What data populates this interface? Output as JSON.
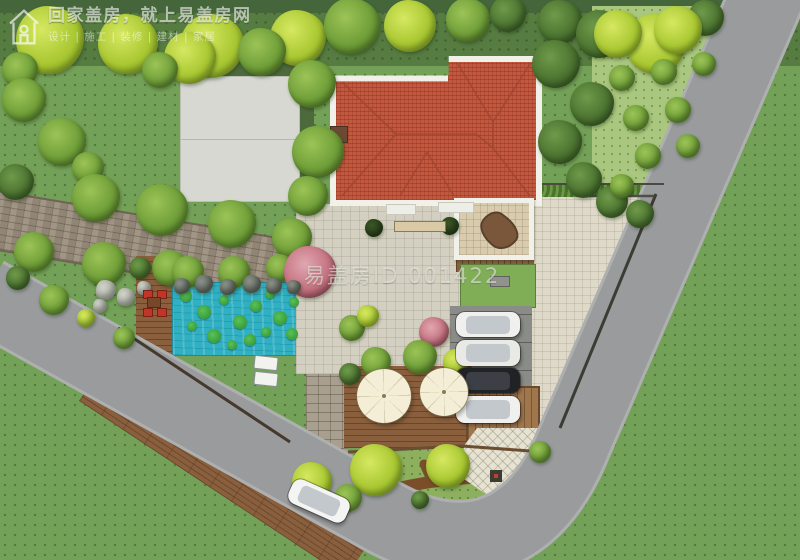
{
  "watermark": {
    "brand": "回家盖房，就上易盖房网",
    "tagline": "设计 | 施工 | 装修 | 建材 | 家居",
    "site_id": "易盖房ID 001422"
  },
  "colors": {
    "grass_base": "#74a158",
    "grass_dark": "#567c41",
    "orchard": "#a9c77e",
    "road": "#999b9d",
    "road_curb": "#aeb0b0",
    "paver_light": "#d4d0c1",
    "paver_warm": "#ded9c9",
    "brick_path": "#9a8d7c",
    "roof": "#c0593f",
    "roof_line": "#a04532",
    "eave_white": "#f1f1ea",
    "pool_water": "#2fb0c3",
    "lily_green": "#2f8f2f",
    "deck_wood": "#8a5f3d",
    "parking_pad": "#8a8c87",
    "fence_dark": "#3c3c35",
    "umbrella_cream": "#f4eed6",
    "car_white": "#f0f0ee",
    "car_black": "#202226",
    "accent_red": "#c03527"
  },
  "scene": {
    "vegetation": [
      [
        50,
        40,
        34,
        "bright"
      ],
      [
        128,
        44,
        30,
        "bright"
      ],
      [
        212,
        46,
        32,
        "bright"
      ],
      [
        298,
        38,
        28,
        "bright"
      ],
      [
        352,
        26,
        28,
        "green"
      ],
      [
        410,
        26,
        26,
        "bright"
      ],
      [
        468,
        20,
        22,
        "green"
      ],
      [
        508,
        14,
        18,
        "dark"
      ],
      [
        560,
        22,
        22,
        "dark"
      ],
      [
        600,
        34,
        24,
        "dark"
      ],
      [
        656,
        44,
        30,
        "bright"
      ],
      [
        706,
        18,
        18,
        "dark"
      ],
      [
        20,
        70,
        18,
        "green"
      ],
      [
        24,
        100,
        22,
        "green"
      ],
      [
        62,
        142,
        24,
        "green"
      ],
      [
        16,
        182,
        18,
        "dark"
      ],
      [
        88,
        168,
        16,
        "green"
      ],
      [
        190,
        58,
        26,
        "bright"
      ],
      [
        262,
        52,
        24,
        "green"
      ],
      [
        160,
        70,
        18,
        "green"
      ],
      [
        312,
        84,
        24,
        "green"
      ],
      [
        318,
        152,
        26,
        "green"
      ],
      [
        308,
        196,
        20,
        "green"
      ],
      [
        96,
        198,
        24,
        "green"
      ],
      [
        162,
        210,
        26,
        "green"
      ],
      [
        232,
        224,
        24,
        "green"
      ],
      [
        292,
        238,
        20,
        "green"
      ],
      [
        34,
        252,
        20,
        "green"
      ],
      [
        104,
        264,
        22,
        "green"
      ],
      [
        170,
        268,
        18,
        "green"
      ],
      [
        188,
        272,
        16,
        "green"
      ],
      [
        234,
        272,
        16,
        "green"
      ],
      [
        280,
        268,
        14,
        "green"
      ],
      [
        310,
        272,
        26,
        "pink"
      ],
      [
        556,
        64,
        24,
        "dark"
      ],
      [
        592,
        104,
        22,
        "dark"
      ],
      [
        560,
        142,
        22,
        "dark"
      ],
      [
        584,
        180,
        18,
        "dark"
      ],
      [
        612,
        202,
        16,
        "dark"
      ],
      [
        640,
        214,
        14,
        "dark"
      ],
      [
        618,
        34,
        24,
        "bright"
      ],
      [
        678,
        30,
        24,
        "bright"
      ],
      [
        622,
        78,
        13,
        "green"
      ],
      [
        664,
        72,
        13,
        "green"
      ],
      [
        704,
        64,
        12,
        "green"
      ],
      [
        636,
        118,
        13,
        "green"
      ],
      [
        678,
        110,
        13,
        "green"
      ],
      [
        648,
        156,
        13,
        "green"
      ],
      [
        688,
        146,
        12,
        "green"
      ],
      [
        622,
        186,
        12,
        "green"
      ],
      [
        434,
        332,
        15,
        "pink"
      ],
      [
        352,
        328,
        13,
        "green"
      ],
      [
        368,
        316,
        11,
        "bright"
      ],
      [
        376,
        362,
        15,
        "green"
      ],
      [
        420,
        357,
        17,
        "green"
      ],
      [
        456,
        362,
        13,
        "bright"
      ],
      [
        350,
        374,
        11,
        "dark"
      ],
      [
        140,
        268,
        11,
        "dark"
      ],
      [
        124,
        338,
        11,
        "green"
      ],
      [
        54,
        300,
        15,
        "green"
      ],
      [
        18,
        278,
        12,
        "dark"
      ],
      [
        86,
        318,
        9,
        "bright"
      ],
      [
        312,
        482,
        20,
        "bright"
      ],
      [
        376,
        470,
        26,
        "bright"
      ],
      [
        448,
        466,
        22,
        "bright"
      ],
      [
        348,
        498,
        14,
        "green"
      ],
      [
        540,
        452,
        11,
        "green"
      ],
      [
        420,
        500,
        9,
        "dark"
      ],
      [
        374,
        228,
        9,
        "darkplant"
      ],
      [
        450,
        226,
        9,
        "darkplant"
      ],
      [
        182,
        286,
        8,
        "rock"
      ],
      [
        204,
        284,
        9,
        "rock"
      ],
      [
        228,
        287,
        8,
        "rock"
      ],
      [
        252,
        284,
        9,
        "rock"
      ],
      [
        274,
        286,
        8,
        "rock"
      ],
      [
        294,
        287,
        7,
        "rock"
      ],
      [
        106,
        290,
        10,
        "rocklight"
      ],
      [
        126,
        297,
        9,
        "rocklight"
      ],
      [
        144,
        288,
        7,
        "rocklight"
      ],
      [
        100,
        306,
        7,
        "rocklight"
      ]
    ],
    "lily_pads": [
      [
        186,
        296,
        6
      ],
      [
        204,
        312,
        7
      ],
      [
        224,
        300,
        5
      ],
      [
        240,
        322,
        7
      ],
      [
        256,
        306,
        6
      ],
      [
        270,
        294,
        5
      ],
      [
        280,
        318,
        7
      ],
      [
        292,
        334,
        6
      ],
      [
        214,
        336,
        7
      ],
      [
        192,
        326,
        5
      ],
      [
        250,
        340,
        6
      ],
      [
        294,
        302,
        5
      ],
      [
        232,
        345,
        5
      ],
      [
        266,
        332,
        5
      ]
    ],
    "cars": [
      {
        "x": 456,
        "y": 312,
        "w": 64,
        "h": 25,
        "body": "#f0f0ee",
        "angle": 0,
        "striped": false
      },
      {
        "x": 456,
        "y": 340,
        "w": 64,
        "h": 26,
        "body": "#e9e9e6",
        "angle": 0,
        "striped": true
      },
      {
        "x": 456,
        "y": 368,
        "w": 64,
        "h": 25,
        "body": "#202226",
        "angle": 0,
        "striped": false
      },
      {
        "x": 456,
        "y": 396,
        "w": 64,
        "h": 27,
        "body": "#f0f0ee",
        "angle": 0,
        "striped": false
      },
      {
        "x": 288,
        "y": 488,
        "w": 62,
        "h": 26,
        "body": "#f4f4f2",
        "angle": 24,
        "striped": false
      }
    ],
    "umbrellas": [
      {
        "cx": 384,
        "cy": 396,
        "r": 27
      },
      {
        "cx": 444,
        "cy": 392,
        "r": 24
      }
    ]
  }
}
